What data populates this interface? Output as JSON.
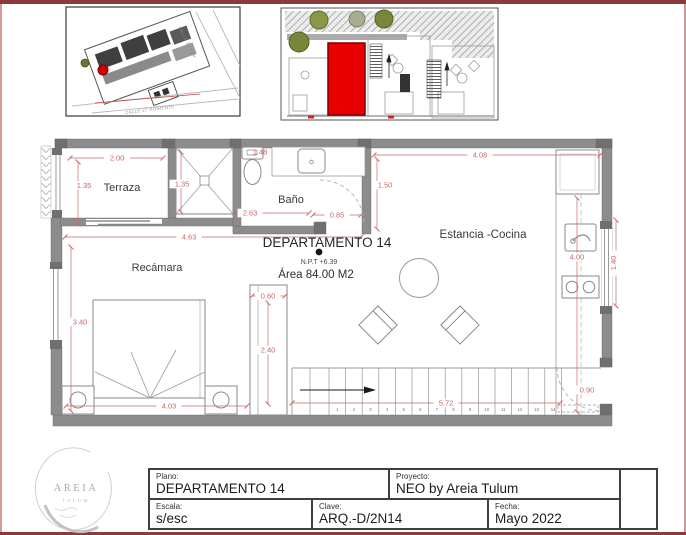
{
  "colors": {
    "frame": "#8d3a3a",
    "wall": "#8c8c8c",
    "dimension_text": "#cc6666",
    "highlight_unit": "#e80000"
  },
  "location_map": {
    "street_right": "CALLE 20 SUR",
    "street_bottom": "CALLE 27 PONIENTE"
  },
  "plan": {
    "apartment_title": "DEPARTAMENTO 14",
    "npt": "N.P.T +6.39",
    "area": "Área 84.00 M2",
    "rooms": {
      "terraza": "Terraza",
      "bano": "Baño",
      "recamara": "Recámara",
      "estancia": "Estancia -Cocina"
    },
    "dims": {
      "terraza_w": "2.00",
      "terraza_h": "1.35",
      "shaft_h": "1.35",
      "bano_top": "1.48",
      "bano_left": "2.63",
      "bano_door": "0.85",
      "recamara_w": "4.63",
      "estancia_w": "4.08",
      "estancia_left": "1.50",
      "recamara_h": "3.40",
      "bed_w": "4.03",
      "closet_w": "0.60",
      "closet_h": "2.40",
      "kitchen_len": "4.00",
      "window_right": "1.40",
      "stairs_len": "5.72",
      "entry_door": "0.90"
    },
    "stairs": {
      "numbers": [
        "1",
        "2",
        "3",
        "4",
        "5",
        "6",
        "7",
        "8",
        "9",
        "10",
        "11",
        "12",
        "13",
        "14"
      ]
    }
  },
  "logo": {
    "brand": "AREIA",
    "sub": "TULUM"
  },
  "titleblock": {
    "plano_label": "Plano:",
    "plano_value": "DEPARTAMENTO 14",
    "proyecto_label": "Proyecto:",
    "proyecto_value": "NEO by Areia Tulum",
    "escala_label": "Escala:",
    "escala_value": "s/esc",
    "clave_label": "Clave:",
    "clave_value": "ARQ.-D/2N14",
    "fecha_label": "Fecha:",
    "fecha_value": "Mayo 2022"
  }
}
